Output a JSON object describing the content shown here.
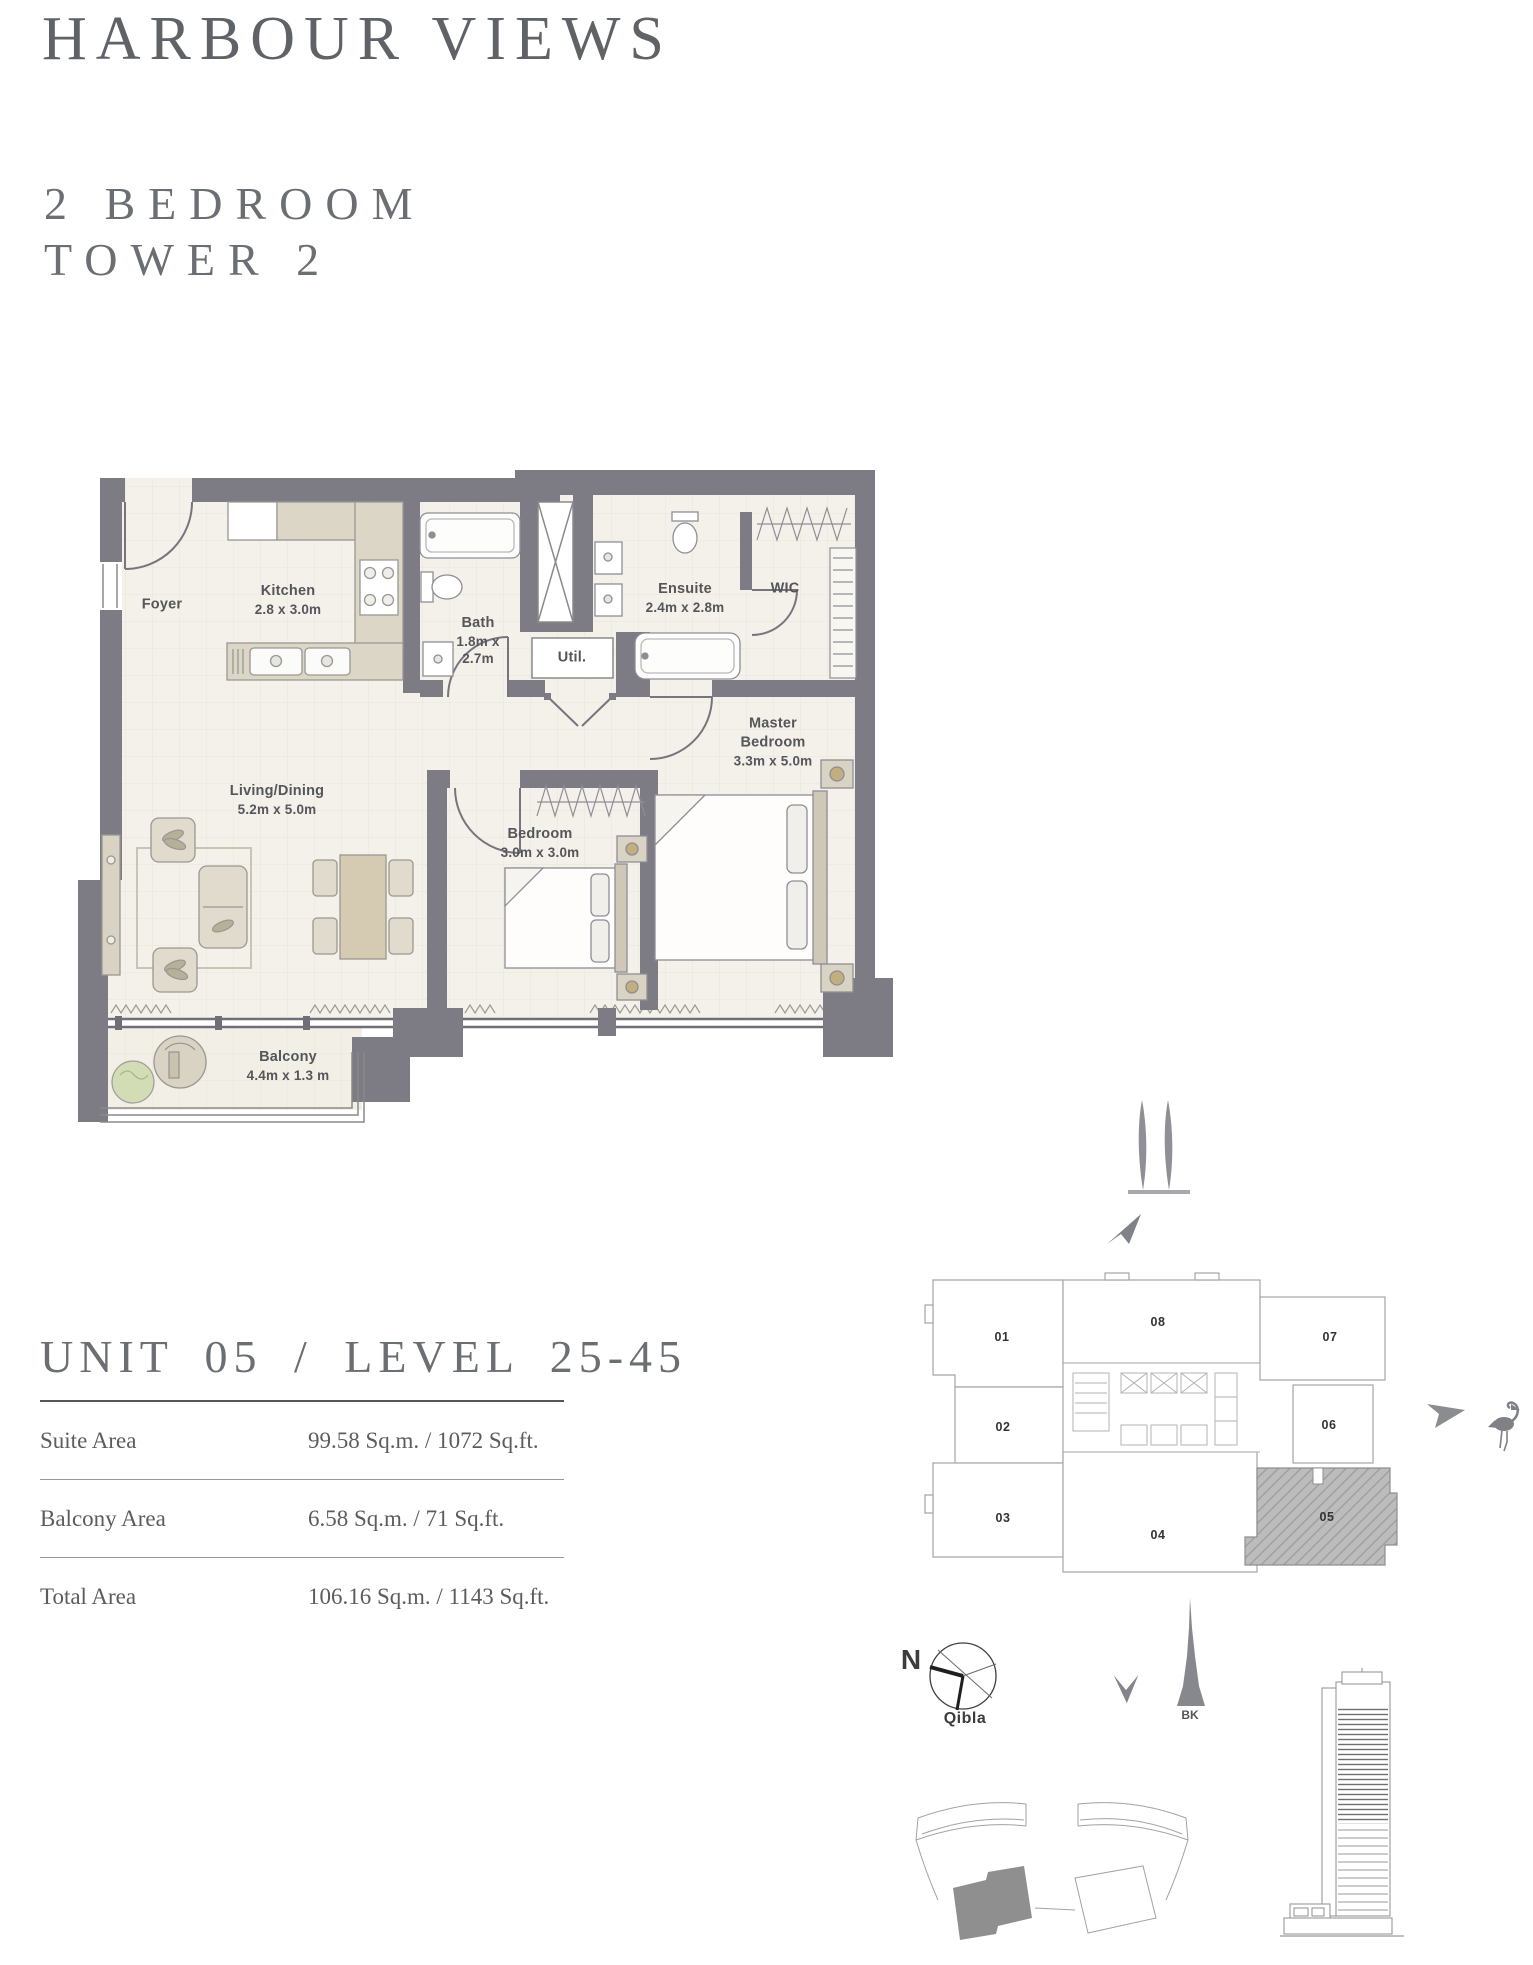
{
  "page": {
    "title": "HARBOUR VIEWS",
    "bedroom_line": "2 BEDROOM",
    "tower_line": "TOWER 2"
  },
  "floor_plan": {
    "rooms": [
      {
        "id": "foyer",
        "name": "Foyer",
        "dims": ""
      },
      {
        "id": "kitchen",
        "name": "Kitchen",
        "dims": "2.8 x 3.0m"
      },
      {
        "id": "bath",
        "name": "Bath",
        "dims": "1.8m x 2.7m"
      },
      {
        "id": "util",
        "name": "Util.",
        "dims": ""
      },
      {
        "id": "ensuite",
        "name": "Ensuite",
        "dims": "2.4m x 2.8m"
      },
      {
        "id": "wic",
        "name": "WIC",
        "dims": ""
      },
      {
        "id": "master-bedroom",
        "name": "Master Bedroom",
        "dims": "3.3m x 5.0m"
      },
      {
        "id": "bedroom",
        "name": "Bedroom",
        "dims": "3.0m x 3.0m"
      },
      {
        "id": "living-dining",
        "name": "Living/Dining",
        "dims": "5.2m x 5.0m"
      },
      {
        "id": "balcony",
        "name": "Balcony",
        "dims": "4.4m x 1.3 m"
      }
    ]
  },
  "unit_info": {
    "heading": "UNIT 05 / LEVEL 25-45",
    "rows": [
      {
        "label": "Suite Area",
        "value": "99.58 Sq.m. / 1072 Sq.ft."
      },
      {
        "label": "Balcony Area",
        "value": "6.58 Sq.m. / 71 Sq.ft."
      },
      {
        "label": "Total Area",
        "value": "106.16 Sq.m. / 1143 Sq.ft."
      }
    ]
  },
  "key_plan": {
    "highlighted_unit": "05",
    "units": [
      {
        "number": "01"
      },
      {
        "number": "02"
      },
      {
        "number": "03"
      },
      {
        "number": "04"
      },
      {
        "number": "05"
      },
      {
        "number": "06"
      },
      {
        "number": "07"
      },
      {
        "number": "08"
      }
    ]
  },
  "compass": {
    "north_label": "N",
    "qibla_label": "Qibla"
  },
  "landmarks": {
    "burj_khalifa_label": "BK"
  },
  "colors": {
    "heading_gray": "#63666a",
    "wall_gray": "#7d7c85",
    "floor_cream": "#f3f1e9",
    "furniture_beige": "#dcd6c6",
    "highlight_hatch": "#bcbcbc",
    "site_highlight": "#8f8f8f"
  }
}
